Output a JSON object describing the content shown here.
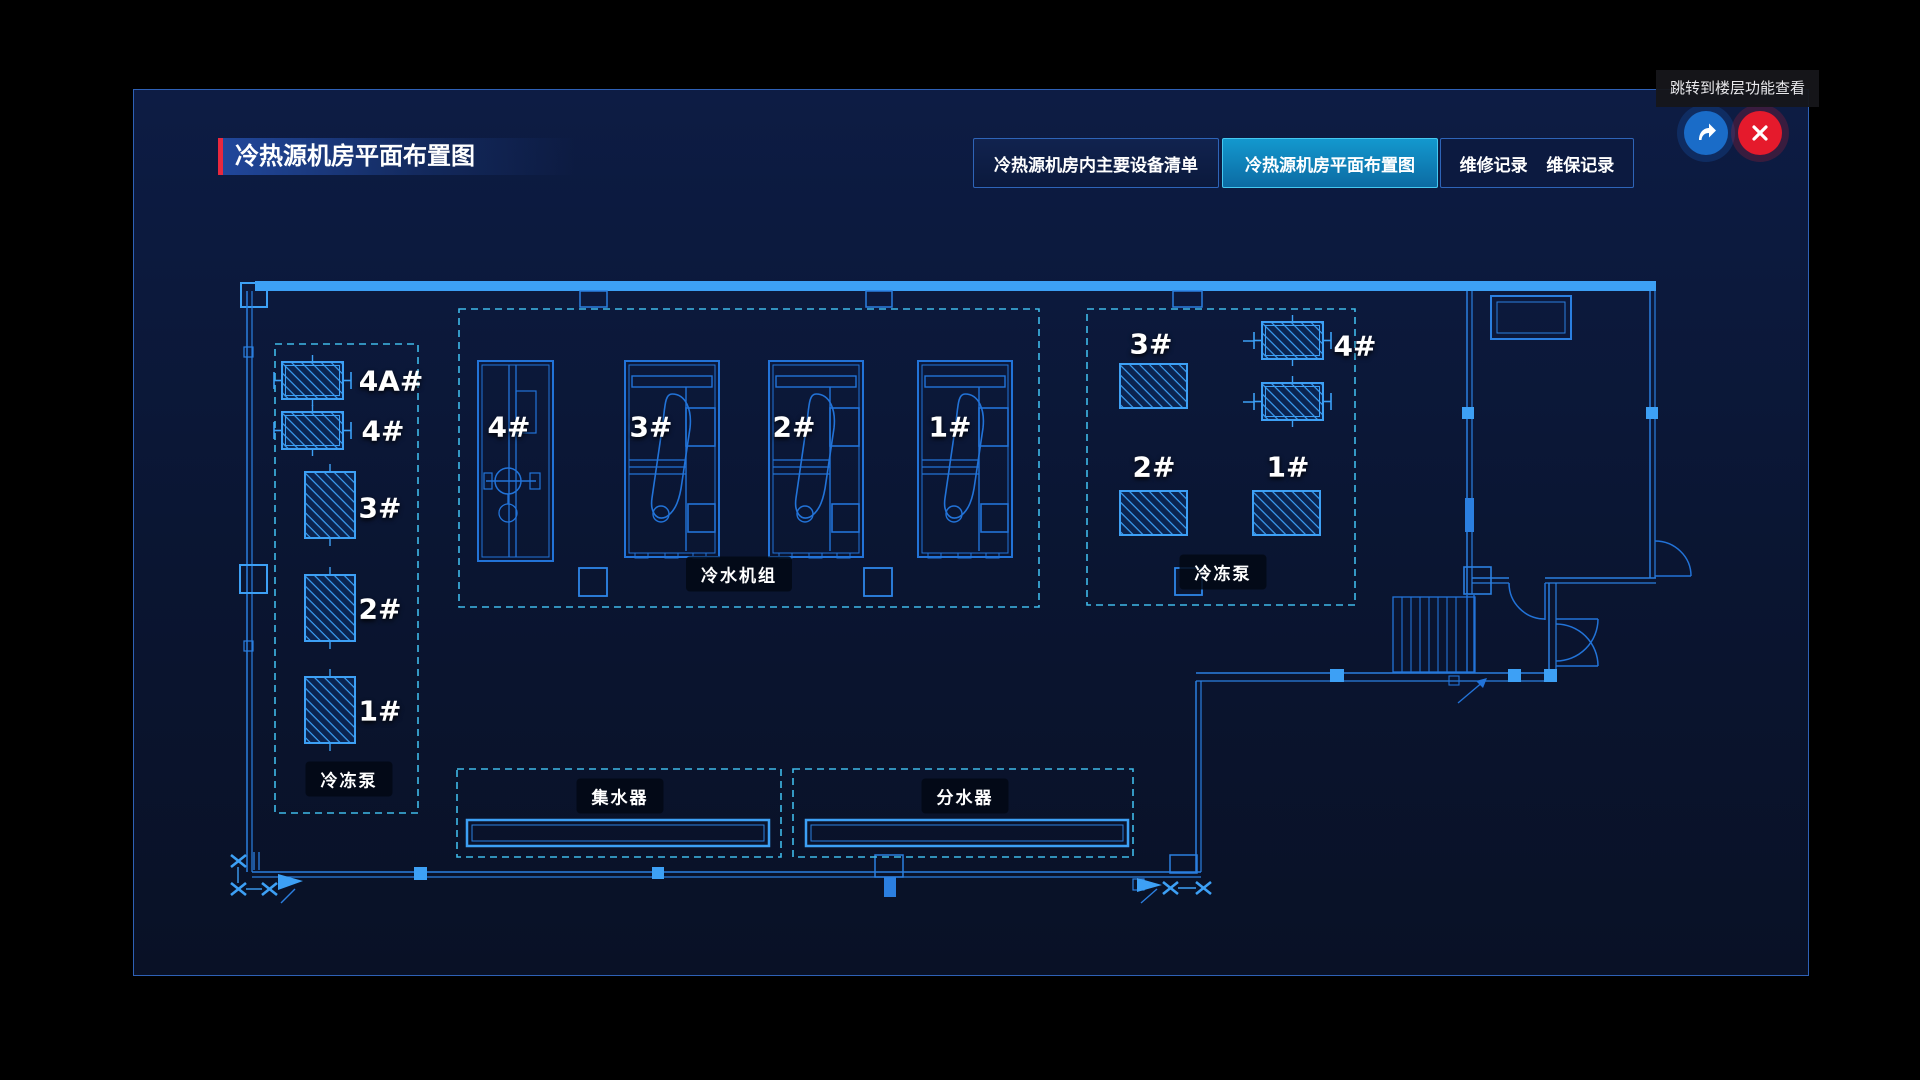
{
  "tooltip": {
    "text": "跳转到楼层功能查看"
  },
  "header": {
    "title": "冷热源机房平面布置图"
  },
  "tabs": [
    {
      "label": "冷热源机房内主要设备清单",
      "active": false
    },
    {
      "label": "冷热源机房平面布置图",
      "active": true
    },
    {
      "label": "维修记录",
      "active": false
    },
    {
      "label": "维保记录",
      "active": false
    }
  ],
  "controls": {
    "share_icon": "share-arrow",
    "close_icon": "close-x"
  },
  "floorplan": {
    "left_pumps": {
      "label": "冷冻泵",
      "units": [
        "4A#",
        "4#",
        "3#",
        "2#",
        "1#"
      ]
    },
    "chillers": {
      "label": "冷水机组",
      "units": [
        "4#",
        "3#",
        "2#",
        "1#"
      ]
    },
    "right_pumps": {
      "label": "冷冻泵",
      "units": [
        "3#",
        "4#",
        "2#",
        "1#"
      ]
    },
    "collector": {
      "label": "集水器"
    },
    "distributor": {
      "label": "分水器"
    },
    "colors": {
      "wall_bright": "#3da0f5",
      "line_mid": "#2273d8",
      "dashed_box": "#3fb9e8",
      "accent_red": "#e8283e"
    }
  }
}
